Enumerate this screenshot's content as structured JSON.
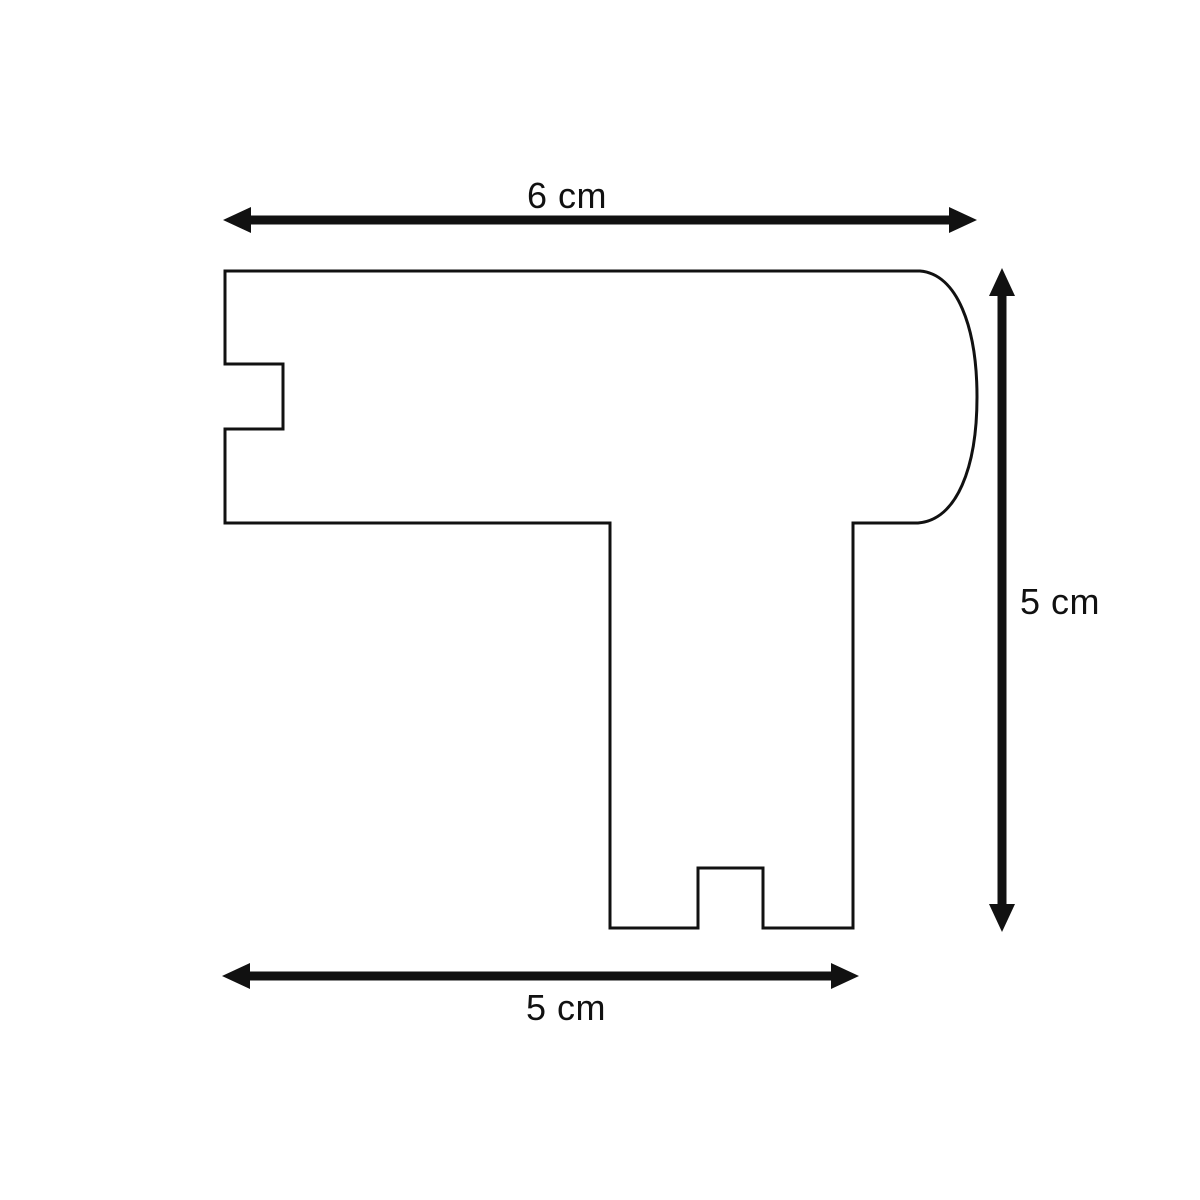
{
  "diagram": {
    "dimensions": {
      "top": {
        "label": "6 cm"
      },
      "right": {
        "label": "5 cm"
      },
      "bottom": {
        "label": "5 cm"
      }
    },
    "colors": {
      "ink": "#111111",
      "background": "#ffffff"
    }
  }
}
